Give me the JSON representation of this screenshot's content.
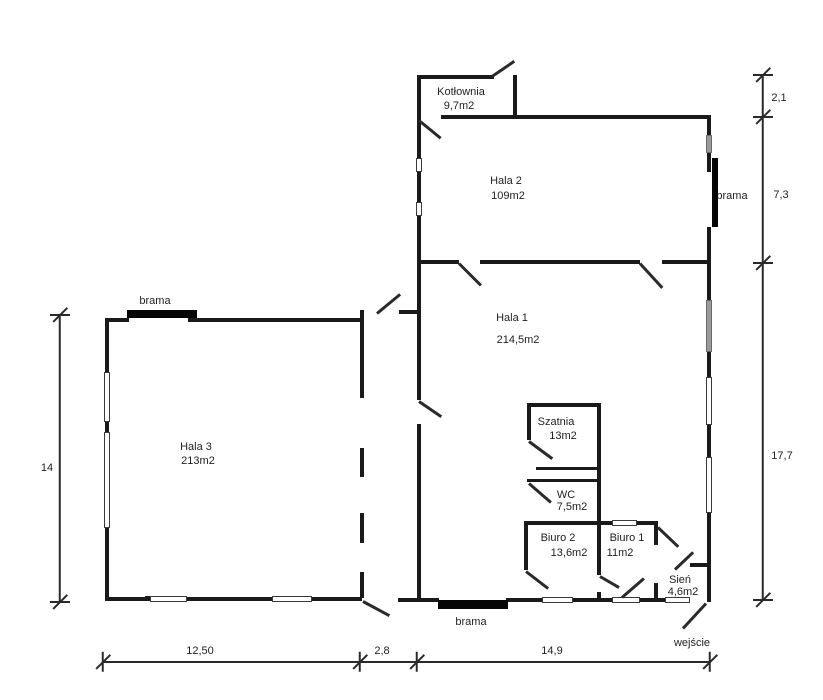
{
  "plan": {
    "rooms": {
      "kotlownia": {
        "name": "Kotłownia",
        "area": "9,7m2"
      },
      "hala2": {
        "name": "Hala 2",
        "area": "109m2"
      },
      "hala1": {
        "name": "Hala 1",
        "area": "214,5m2"
      },
      "hala3": {
        "name": "Hala 3",
        "area": "213m2"
      },
      "szatnia": {
        "name": "Szatnia",
        "area": "13m2"
      },
      "wc": {
        "name": "WC",
        "area": "7,5m2"
      },
      "biuro2": {
        "name": "Biuro 2",
        "area": "13,6m2"
      },
      "biuro1": {
        "name": "Biuro 1",
        "area": "11m2"
      },
      "sien": {
        "name": "Sień",
        "area": "4,6m2"
      }
    },
    "annotations": {
      "brama_left": "brama",
      "brama_right": "brama",
      "brama_bottom": "brama",
      "wejscie": "wejście"
    },
    "dimensions": {
      "right_top": "2,1",
      "right_mid": "7,3",
      "right_bottom": "17,7",
      "left": "14",
      "bottom_left": "12,50",
      "bottom_mid": "2,8",
      "bottom_right": "14,9"
    },
    "colors": {
      "wall": "#1a1a1a",
      "window_gray": "#9a9a9a"
    }
  }
}
